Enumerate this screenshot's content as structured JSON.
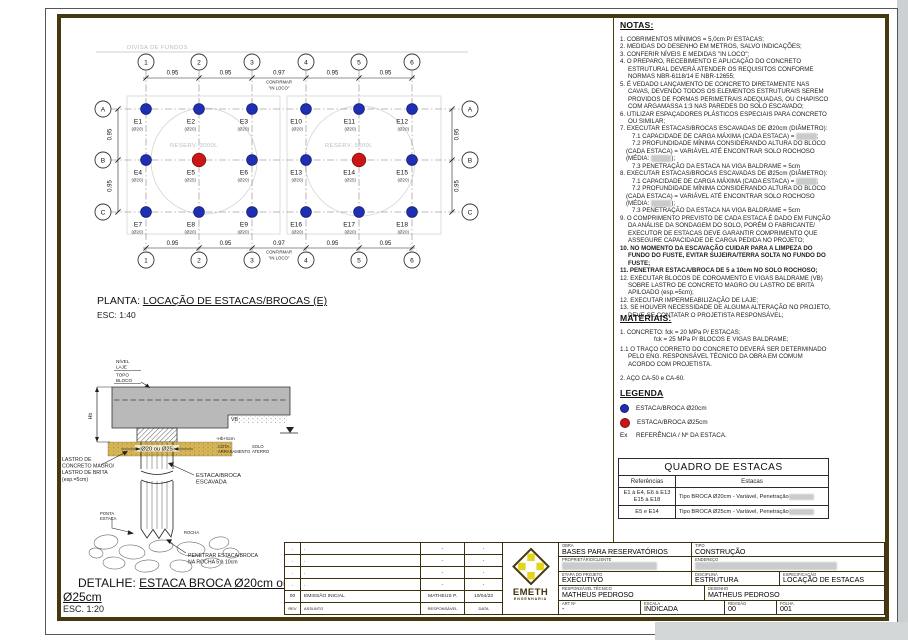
{
  "plan": {
    "divisa": "DIVISA DE FUNDOS",
    "title_prefix": "PLANTA: ",
    "title_u": "LOCAÇÃO DE ESTACAS/BROCAS (E)",
    "scale": "ESC: 1:40",
    "cols": [
      "1",
      "2",
      "3",
      "4",
      "5",
      "6"
    ],
    "rows": [
      "A",
      "B",
      "C"
    ],
    "dims_h": [
      "0.95",
      "0.95",
      "0.97",
      "0.95",
      "0.95"
    ],
    "dim_note1": "CONFIRMAR",
    "dim_note2": "\"IN LOCO\"",
    "dims_v": [
      "0.95",
      "0.95"
    ],
    "reservoirs": [
      {
        "label": "RESERV. 3000L"
      },
      {
        "label": "RESERV. 5000L"
      }
    ],
    "piles": [
      {
        "id": "E1",
        "dia": "(Ø20)",
        "col": 0,
        "row": 0
      },
      {
        "id": "E2",
        "dia": "(Ø20)",
        "col": 1,
        "row": 0
      },
      {
        "id": "E3",
        "dia": "(Ø20)",
        "col": 2,
        "row": 0
      },
      {
        "id": "E10",
        "dia": "(Ø20)",
        "col": 3,
        "row": 0
      },
      {
        "id": "E11",
        "dia": "(Ø20)",
        "col": 4,
        "row": 0
      },
      {
        "id": "E12",
        "dia": "(Ø20)",
        "col": 5,
        "row": 0
      },
      {
        "id": "E4",
        "dia": "(Ø20)",
        "col": 0,
        "row": 1
      },
      {
        "id": "E5",
        "dia": "(Ø25)",
        "col": 1,
        "row": 1
      },
      {
        "id": "E6",
        "dia": "(Ø20)",
        "col": 2,
        "row": 1
      },
      {
        "id": "E13",
        "dia": "(Ø20)",
        "col": 3,
        "row": 1
      },
      {
        "id": "E14",
        "dia": "(Ø25)",
        "col": 4,
        "row": 1
      },
      {
        "id": "E15",
        "dia": "(Ø20)",
        "col": 5,
        "row": 1
      },
      {
        "id": "E7",
        "dia": "(Ø20)",
        "col": 0,
        "row": 2
      },
      {
        "id": "E8",
        "dia": "(Ø20)",
        "col": 1,
        "row": 2
      },
      {
        "id": "E9",
        "dia": "(Ø20)",
        "col": 2,
        "row": 2
      },
      {
        "id": "E16",
        "dia": "(Ø20)",
        "col": 3,
        "row": 2
      },
      {
        "id": "E17",
        "dia": "(Ø20)",
        "col": 4,
        "row": 2
      },
      {
        "id": "E18",
        "dia": "(Ø20)",
        "col": 5,
        "row": 2
      }
    ]
  },
  "plan_colors": {
    "blue": "#1f2fb4",
    "red": "#cc1517"
  },
  "notes": {
    "heading": "NOTAS:",
    "items": [
      {
        "t": "1. COBRIMENTOS MÍNIMOS = 5,0cm P/ ESTACAS;"
      },
      {
        "t": "2. MEDIDAS DO DESENHO EM METROS, SALVO INDICAÇÕES;"
      },
      {
        "t": "3. CONFERIR NÍVEIS E MEDIDAS \"IN LOCO\";"
      },
      {
        "t": "4. O PREPARO, RECEBIMENTO E APLICAÇÃO DO CONCRETO ESTRUTURAL DEVERÁ ATENDER OS REQUISITOS CONFORME NORMAS NBR-6118/14 E NBR-12655;"
      },
      {
        "t": "5. É VEDADO LANÇAMENTO DE CONCRETO DIRETAMENTE NAS CAVAS, DEVENDO TODOS OS ELEMENTOS ESTRUTURAIS SEREM PROVIDOS DE FORMAS PERIMETRAIS ADEQUADAS, OU CHAPISCO COM ARGAMASSA 1:3 NAS PAREDES DO SOLO ESCAVADO;"
      },
      {
        "t": "6. UTILIZAR ESPAÇADORES PLÁSTICOS ESPECIAIS PARA CONCRETO OU SIMILAR;"
      },
      {
        "t": "7. EXECUTAR ESTACAS/BROCAS ESCAVADAS DE Ø20cm (DIÂMETRO):"
      },
      {
        "t": "7.1 CAPACIDADE DE CARGA MÁXIMA (CADA ESTACA) = ",
        "sub": true,
        "redact": "######",
        "after": ";"
      },
      {
        "t": "7.2 PROFUNDIDADE MÍNIMA CONSIDERANDO ALTURA DO BLOCO (CADA ESTACA) = VARIÁVEL ATÉ ENCONTRAR SOLO ROCHOSO (MÉDIA: ",
        "sub": true,
        "redact": "######",
        "after": ");"
      },
      {
        "t": "7.3 PENETRAÇÃO DA ESTACA NA VIGA BALDRAME = 5cm",
        "sub": true
      },
      {
        "t": "8. EXECUTAR ESTACAS/BROCAS ESCAVADAS DE Ø25cm (DIÂMETRO):"
      },
      {
        "t": "7.1 CAPACIDADE DE CARGA MÁXIMA (CADA ESTACA) = ",
        "sub": true,
        "redact": "######",
        "after": ";"
      },
      {
        "t": "7.2 PROFUNDIDADE MÍNIMA CONSIDERANDO ALTURA DO BLOCO (CADA ESTACA) = VARIÁVEL ATÉ ENCONTRAR SOLO ROCHOSO (MÉDIA: ",
        "sub": true,
        "redact": "######",
        "after": ");"
      },
      {
        "t": "7.3 PENETRAÇÃO DA ESTACA NA VIGA BALDRAME = 5cm",
        "sub": true
      },
      {
        "t": "9. O COMPRIMENTO PREVISTO DE CADA ESTACA É DADO EM FUNÇÃO DA ANÁLISE DA SONDAGEM DO SOLO, PORÉM O FABRICANTE/ EXECUTOR DE ESTACAS DEVE GARANTIR COMPRIMENTO QUE ASSEGURE CAPACIDADE DE CARGA PEDIDA NO PROJETO;"
      },
      {
        "t": "10. NO MOMENTO DA ESCAVAÇÃO CUIDAR PARA A LIMPEZA DO FUNDO DO FUSTE, EVITAR SUJEIRA/TERRA SOLTA NO FUNDO DO FUSTE;",
        "b": true
      },
      {
        "t": "11. PENETRAR ESTACA/BROCA DE 5 a 10cm NO SOLO ROCHOSO;",
        "b": true
      },
      {
        "t": "12. EXECUTAR BLOCOS DE COROAMENTO E VIGAS BALDRAME (VB) SOBRE LASTRO DE CONCRETO MAGRO OU LASTRO DE BRITA APILOADO (esp.=5cm);"
      },
      {
        "t": "12. EXECUTAR IMPERMEABILIZAÇÃO DE LAJE;"
      },
      {
        "t": "13. SE HOUVER NECESSIDADE DE ALGUMA ALTERAÇÃO NO PROJETO, DEVE-SE CONTATAR O PROJETISTA RESPONSÁVEL;"
      }
    ]
  },
  "materials": {
    "heading": "MATERIAIS:",
    "items": [
      {
        "t": "1. CONCRETO: fck = 20 MPa P/ ESTACAS;"
      },
      {
        "t": "fck = 25 MPa P/ BLOCOS E VIGAS BALDRAME;",
        "cls": "indent2"
      },
      {
        "t": "1.1 O TRAÇO CORRETO DO CONCRETO DEVERÁ SER DETERMINADO PELO ENG. RESPONSÁVEL TÉCNICO DA OBRA EM COMUM ACORDO COM PROJETISTA.",
        "cls": "gap-s"
      },
      {
        "t": "2. AÇO CA-50 e CA-60.",
        "cls": "gap"
      }
    ]
  },
  "legend": {
    "heading": "LEGENDA",
    "items": [
      {
        "swatch": "blue",
        "label": "ESTACA/BROCA Ø20cm"
      },
      {
        "swatch": "red",
        "label": "ESTACA/BROCA Ø25cm"
      },
      {
        "prefix": "Ex",
        "label": "REFERÊNCIA / Nº DA ESTACA."
      }
    ]
  },
  "quadro": {
    "title": "QUADRO DE ESTACAS",
    "headers": [
      "Referências",
      "Estacas"
    ],
    "rows": [
      {
        "ref": "E1 à E4, E6 à E13\nE15 à E18",
        "desc": "Tipo BROCA Ø20cm - Variável, Penetração ",
        "redact": "########"
      },
      {
        "ref": "E5 e E14",
        "desc": "Tipo BROCA Ø25cm - Variável, Penetração ",
        "redact": "########"
      }
    ]
  },
  "detail": {
    "title_prefix": "DETALHE: ",
    "title_u1": "ESTACA BROCA Ø20cm ou",
    "title_u2": "Ø25cm",
    "scale": "ESC. 1:20",
    "labels": {
      "nivel_laje": [
        "NÍVEL",
        "LAJE"
      ],
      "topo_bloco": [
        "TOPO",
        "BLOCO"
      ],
      "hb": "Hb",
      "vb": "VB",
      "cota": "-Hb+5cm",
      "cota_arrasamento": [
        "COTA",
        "ARRASAMENTO"
      ],
      "solo_aterro": [
        "SOLO",
        "ATERRO"
      ],
      "lastro": [
        "LASTRO DE",
        "CONCRETO MAGRO/",
        "LASTRO DE BRITA",
        "(esp.=5cm)"
      ],
      "dia": "Ø20 ou Ø25",
      "estaca_broca": [
        "ESTACA/BROCA",
        "ESCAVADA"
      ],
      "ponta": [
        "PONTA",
        "ESTACA"
      ],
      "rocha": "ROCHA",
      "penetrar": [
        "PENETRAR ESTACA/BROCA",
        "NA ROCHA 5 à 10cm"
      ]
    }
  },
  "titleblock": {
    "logo": {
      "name": "EMETH",
      "sub": "ENGENHARIA"
    },
    "rev_table": {
      "headers": [
        "REV",
        "ASSUNTO",
        "RESPONSÁVEL",
        "DATA"
      ],
      "empty_row": [
        ".",
        ".",
        "-",
        "-"
      ],
      "emission": [
        "00",
        "EMISSÃO INICIAL",
        "MATHEUS P.",
        "10/04/23"
      ]
    },
    "fields": {
      "obra": {
        "label": "OBRA",
        "value": "BASES PARA RESERVATÓRIOS"
      },
      "tipo": {
        "label": "TIPO",
        "value": "CONSTRUÇÃO"
      },
      "proprietario": {
        "label": "PROPRIETÁRIO/CLIENTE",
        "redacted": "########################"
      },
      "endereco": {
        "label": "ENDEREÇO",
        "redacted": "####################################"
      },
      "etapa": {
        "label": "ETAPA DO PROJETO",
        "value": "EXECUTIVO"
      },
      "disciplina": {
        "label": "DISCIPLINA",
        "value": "ESTRUTURA"
      },
      "especificacao": {
        "label": "ESPECIFICAÇÃO",
        "value": "LOCAÇÃO DE ESTACAS"
      },
      "resp": {
        "label": "RESPONSÁVEL TÉCNICO",
        "value": "MATHEUS PEDROSO"
      },
      "desenho": {
        "label": "DESENHO",
        "value": "MATHEUS PEDROSO"
      },
      "art": {
        "label": "ART Nº",
        "value": "-"
      },
      "escala": {
        "label": "ESCALA",
        "value": "INDICADA"
      },
      "revisao": {
        "label": "REVISÃO",
        "value": "00"
      },
      "folha": {
        "label": "FOLHA",
        "value": "001"
      }
    }
  }
}
